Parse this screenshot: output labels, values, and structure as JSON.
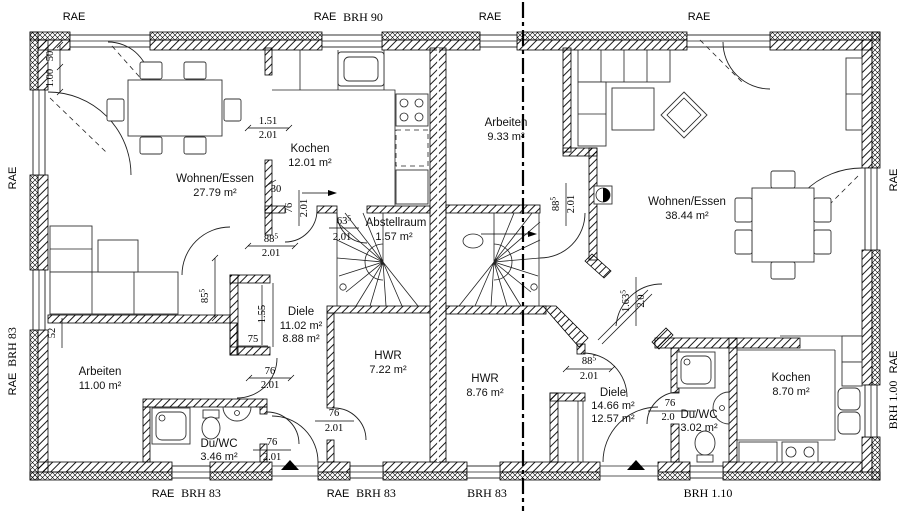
{
  "labels": {
    "rae": "RAE",
    "brh90": "BRH 90",
    "brh83": "BRH 83",
    "brh110": "BRH 1.10",
    "brh100": "BRH 1.00"
  },
  "rooms_left": [
    {
      "name": "Wohnen/Essen",
      "area": "27.79 m²"
    },
    {
      "name": "Kochen",
      "area": "12.01 m²"
    },
    {
      "name": "Arbeiten",
      "area": "11.00 m²"
    },
    {
      "name": "Diele",
      "area": "11.02 m²",
      "area2": "8.88 m²"
    },
    {
      "name": "HWR",
      "area": "7.22 m²"
    },
    {
      "name": "Du/WC",
      "area": "3.46 m²"
    },
    {
      "name": "Abstellraum",
      "area": "1.57 m²"
    }
  ],
  "rooms_right": [
    {
      "name": "Arbeiten",
      "area": "9.33 m²"
    },
    {
      "name": "Wohnen/Essen",
      "area": "38.44 m²"
    },
    {
      "name": "Kochen",
      "area": "8.70 m²"
    },
    {
      "name": "HWR",
      "area": "8.76 m²"
    },
    {
      "name": "Diele",
      "area": "14.66 m²",
      "area2": "12.57 m²"
    },
    {
      "name": "Du/WC",
      "area": "3.02 m²"
    }
  ],
  "dims": {
    "n50": "50",
    "n100": "1.00",
    "n151": "1.51",
    "n201": "2.01",
    "n30": "30",
    "n76": "76",
    "n63": "63",
    "n88": "88",
    "n85": "85",
    "sup5": "5",
    "n155": "1.55",
    "n75": "75",
    "n52": "52",
    "n163": "1.63",
    "n20": "2.0"
  }
}
